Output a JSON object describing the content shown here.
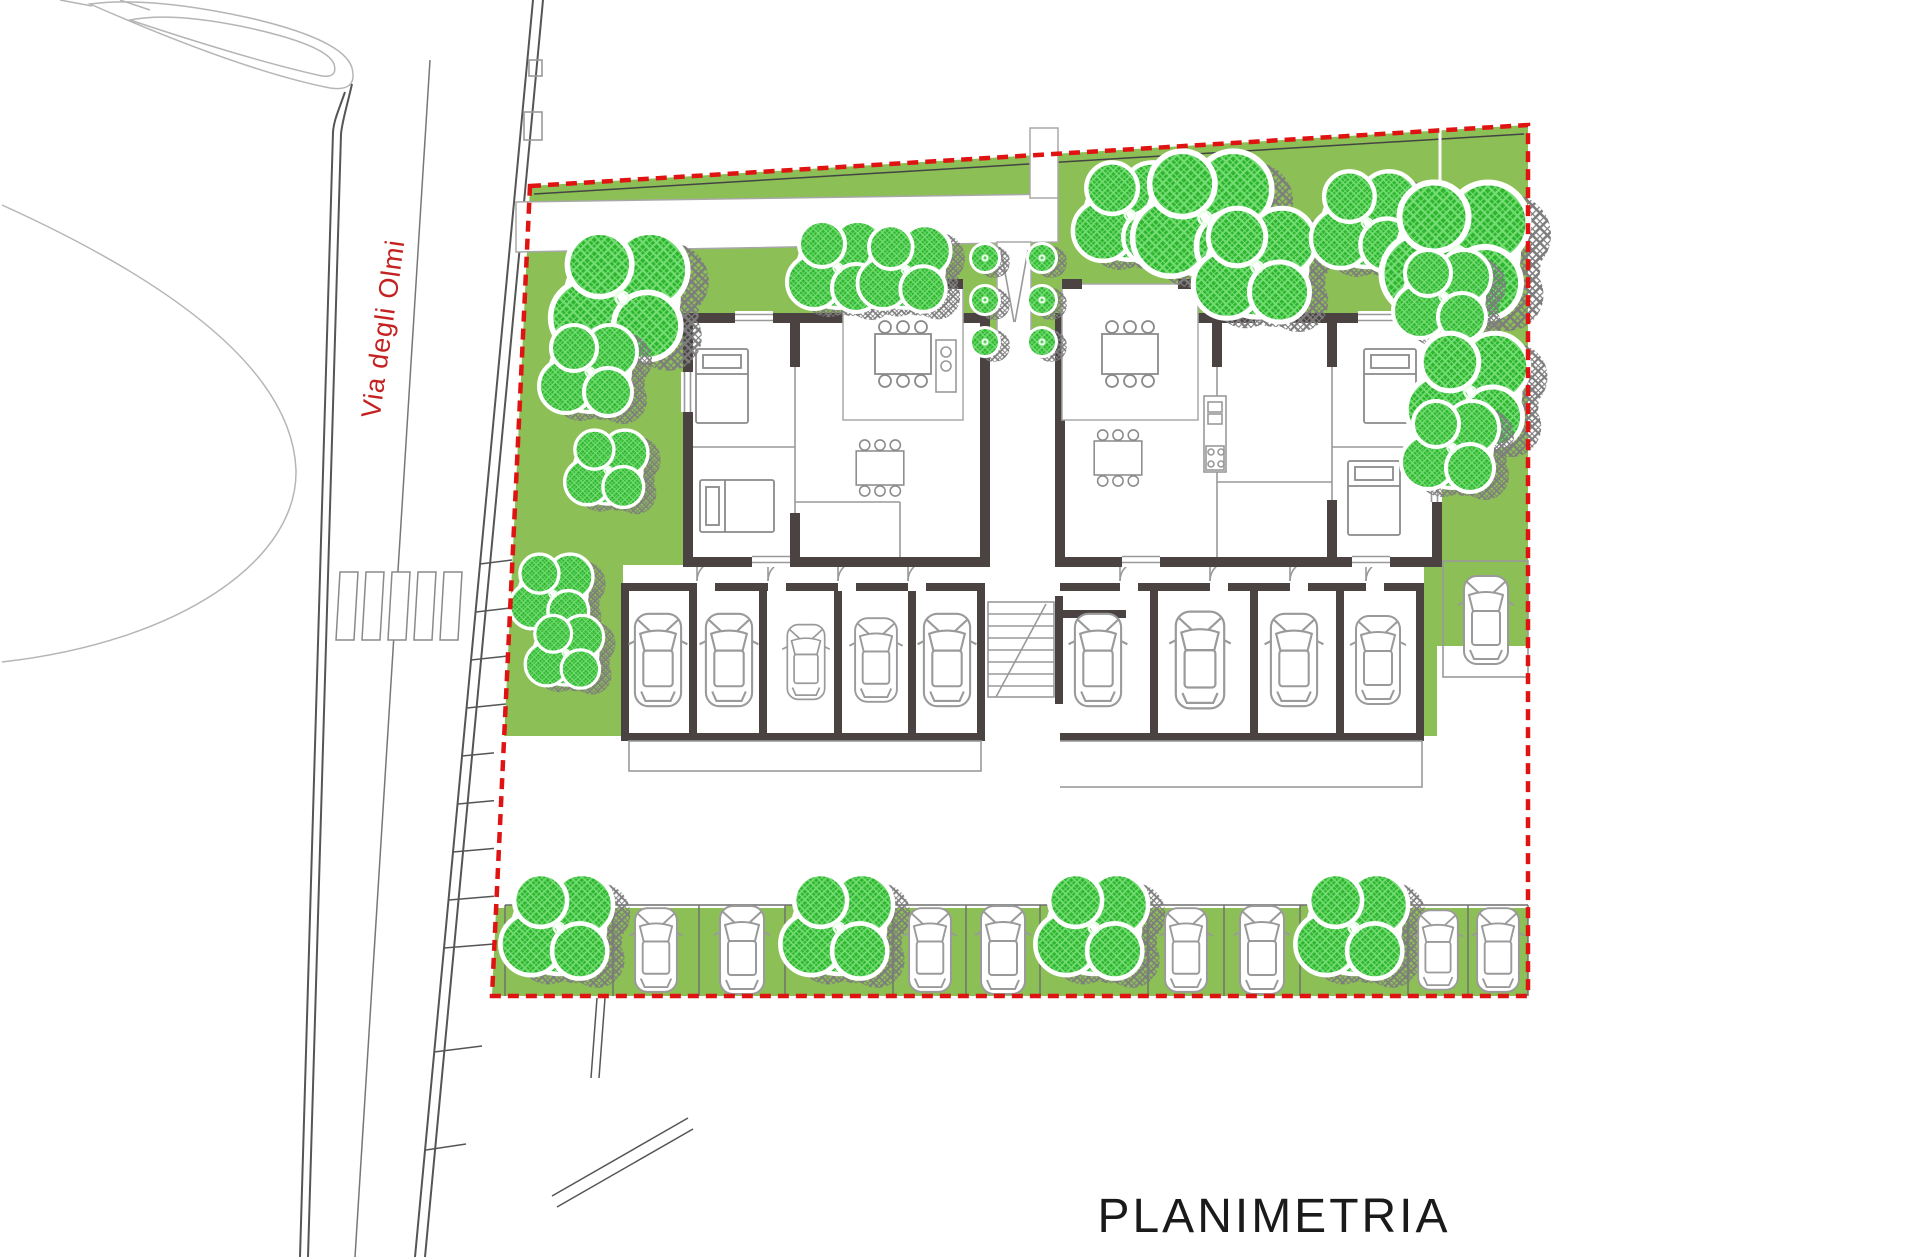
{
  "title": {
    "label": "PLANIMETRIA"
  },
  "street": {
    "label": "Via degli Olmi"
  },
  "colors": {
    "lawn": "#8cbf55",
    "tree": "#2db52d",
    "tree-hatch": "#74dd74",
    "shadow": "#7d7d7d",
    "wall": "#4a4342",
    "boundary": "#e01313",
    "street-label": "#c42121",
    "title-color": "#1a1a1a"
  },
  "features": {
    "boundary_style": "red dashed property line",
    "lawn_trees": 15,
    "parking_row": {
      "tree_cells": 4,
      "cars": 8
    },
    "garages": {
      "left_cars": 5,
      "right_cars": 4
    },
    "right_parking_cars": 1,
    "entrance_bushes": 6
  }
}
